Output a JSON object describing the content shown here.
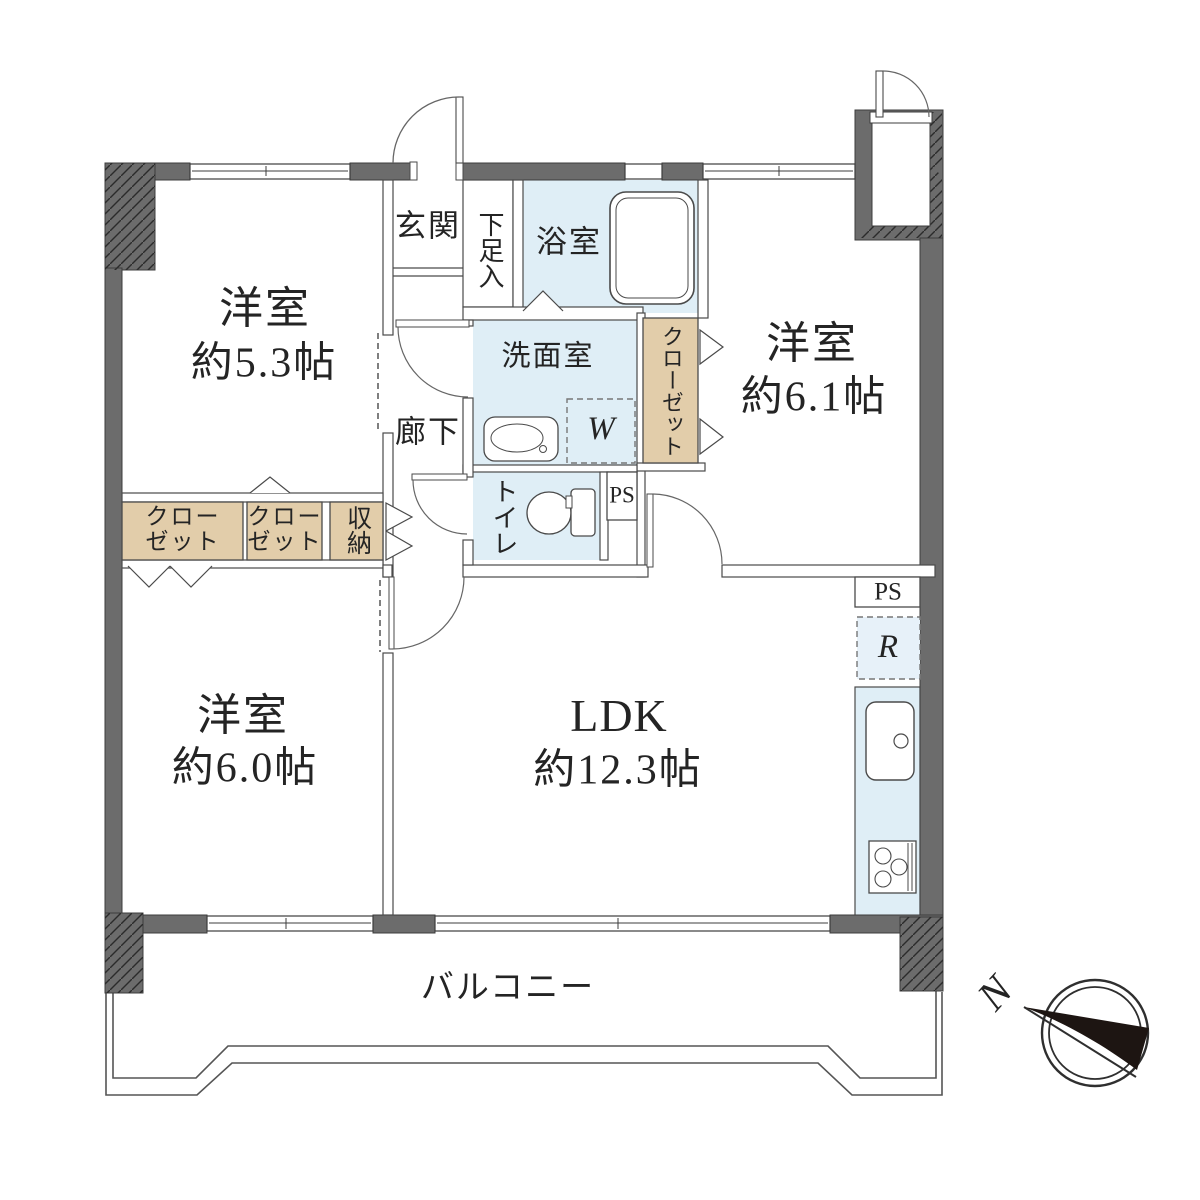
{
  "meta": {
    "type": "apartment-floor-plan"
  },
  "colors": {
    "wall_fill": "#6c6c6c",
    "water_area_fill": "#dfeef6",
    "closet_fill": "#e2cdaa",
    "line": "#4a4a4a"
  },
  "rooms": {
    "western_5_3": {
      "name": "洋室",
      "size": "約5.3帖"
    },
    "western_6_1": {
      "name": "洋室",
      "size": "約6.1帖"
    },
    "western_6_0": {
      "name": "洋室",
      "size": "約6.0帖"
    },
    "ldk": {
      "name": "LDK",
      "size": "約12.3帖"
    },
    "entrance": {
      "name": "玄関"
    },
    "hallway": {
      "name": "廊下"
    },
    "bathroom": {
      "name": "浴室"
    },
    "washroom": {
      "name": "洗面室"
    },
    "toilet": {
      "name": "トイレ"
    },
    "shoe_cabinet": {
      "name": "下足入"
    },
    "balcony": {
      "name": "バルコニー"
    }
  },
  "storage": {
    "closet_left": {
      "line1": "クロー",
      "line2": "ゼット"
    },
    "closet_mid": {
      "line1": "クロー",
      "line2": "ゼット"
    },
    "closet_vertical": {
      "name": "クローゼット"
    },
    "shuno": {
      "name": "収納"
    }
  },
  "labels": {
    "ps_toilet": "PS",
    "ps_kitchen": "PS",
    "washer": "W",
    "fridge": "R",
    "north": "N"
  }
}
